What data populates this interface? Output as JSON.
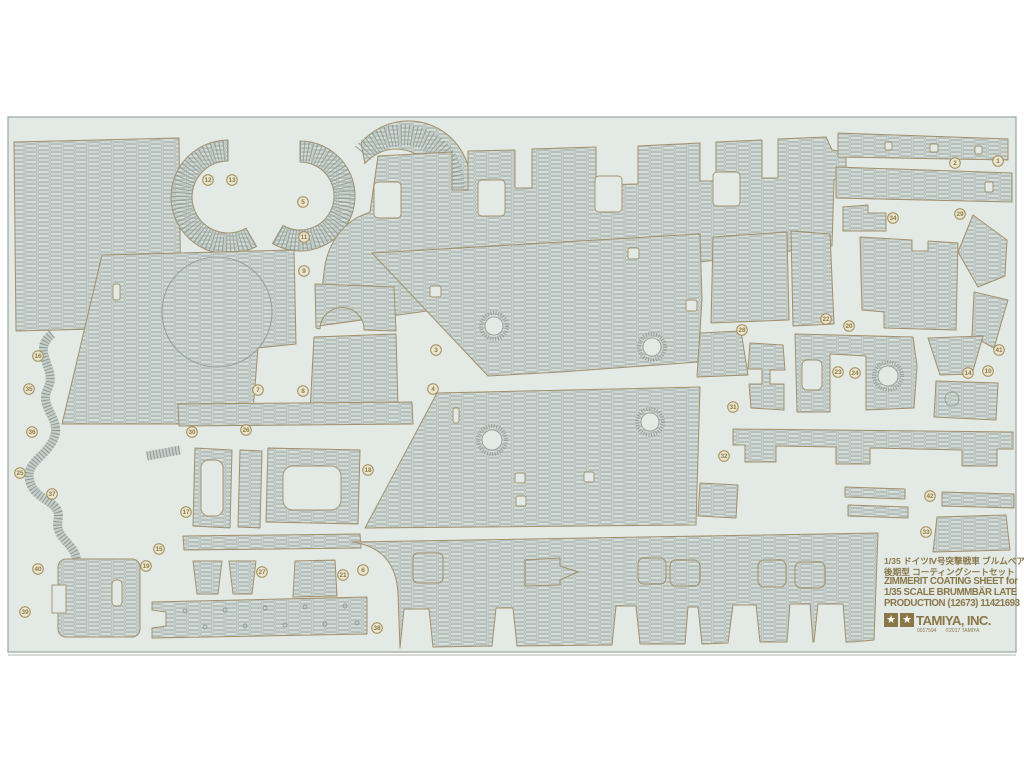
{
  "page": {
    "background": "#ffffff"
  },
  "sheet": {
    "background": "#e3e9e5",
    "border_color": "#9aa49f",
    "piece_fill": "#c9d2ce",
    "piece_outline": "#a3906a",
    "label_color": "#8f7b46",
    "label_ring_fill": "#e9e5d0"
  },
  "info_block": {
    "line_jp_1": "1/35 ドイツⅣ号突撃戦車 ブルムベア",
    "line_jp_2": "後期型 コーティングシートセット",
    "line_en_1": "ZIMMERIT COATING SHEET for",
    "line_en_2": "1/35 SCALE  BRUMMBÄR LATE",
    "line_en_3": "PRODUCTION (12673) 11421693",
    "brand": "TAMIYA, INC.",
    "print_code": "0017594",
    "copyright": "©2017 TAMIYA",
    "logo_icon": "tamiya-twin-star"
  },
  "part_labels": [
    {
      "n": "1",
      "x": 998,
      "y": 161
    },
    {
      "n": "2",
      "x": 955,
      "y": 163
    },
    {
      "n": "3",
      "x": 436,
      "y": 350
    },
    {
      "n": "4",
      "x": 433,
      "y": 389
    },
    {
      "n": "5",
      "x": 303,
      "y": 202
    },
    {
      "n": "6",
      "x": 363,
      "y": 570
    },
    {
      "n": "7",
      "x": 258,
      "y": 390
    },
    {
      "n": "8",
      "x": 303,
      "y": 391
    },
    {
      "n": "9",
      "x": 304,
      "y": 271
    },
    {
      "n": "10",
      "x": 988,
      "y": 371
    },
    {
      "n": "11",
      "x": 304,
      "y": 237
    },
    {
      "n": "12",
      "x": 208,
      "y": 180
    },
    {
      "n": "13",
      "x": 232,
      "y": 180
    },
    {
      "n": "14",
      "x": 968,
      "y": 373
    },
    {
      "n": "15",
      "x": 159,
      "y": 549
    },
    {
      "n": "16",
      "x": 38,
      "y": 356
    },
    {
      "n": "17",
      "x": 186,
      "y": 512
    },
    {
      "n": "18",
      "x": 368,
      "y": 470
    },
    {
      "n": "19",
      "x": 146,
      "y": 566
    },
    {
      "n": "20",
      "x": 849,
      "y": 326
    },
    {
      "n": "21",
      "x": 343,
      "y": 575
    },
    {
      "n": "22",
      "x": 826,
      "y": 319
    },
    {
      "n": "23",
      "x": 838,
      "y": 372
    },
    {
      "n": "24",
      "x": 855,
      "y": 373
    },
    {
      "n": "25",
      "x": 20,
      "y": 473
    },
    {
      "n": "26",
      "x": 246,
      "y": 430
    },
    {
      "n": "27",
      "x": 262,
      "y": 572
    },
    {
      "n": "28",
      "x": 742,
      "y": 330
    },
    {
      "n": "29",
      "x": 960,
      "y": 214
    },
    {
      "n": "30",
      "x": 192,
      "y": 432
    },
    {
      "n": "31",
      "x": 733,
      "y": 407
    },
    {
      "n": "32",
      "x": 724,
      "y": 456
    },
    {
      "n": "33",
      "x": 926,
      "y": 532
    },
    {
      "n": "34",
      "x": 893,
      "y": 218
    },
    {
      "n": "35",
      "x": 29,
      "y": 389
    },
    {
      "n": "36",
      "x": 32,
      "y": 432
    },
    {
      "n": "37",
      "x": 52,
      "y": 494
    },
    {
      "n": "38",
      "x": 377,
      "y": 628
    },
    {
      "n": "39",
      "x": 25,
      "y": 612
    },
    {
      "n": "40",
      "x": 38,
      "y": 569
    },
    {
      "n": "41",
      "x": 999,
      "y": 350
    },
    {
      "n": "42",
      "x": 930,
      "y": 496
    }
  ]
}
